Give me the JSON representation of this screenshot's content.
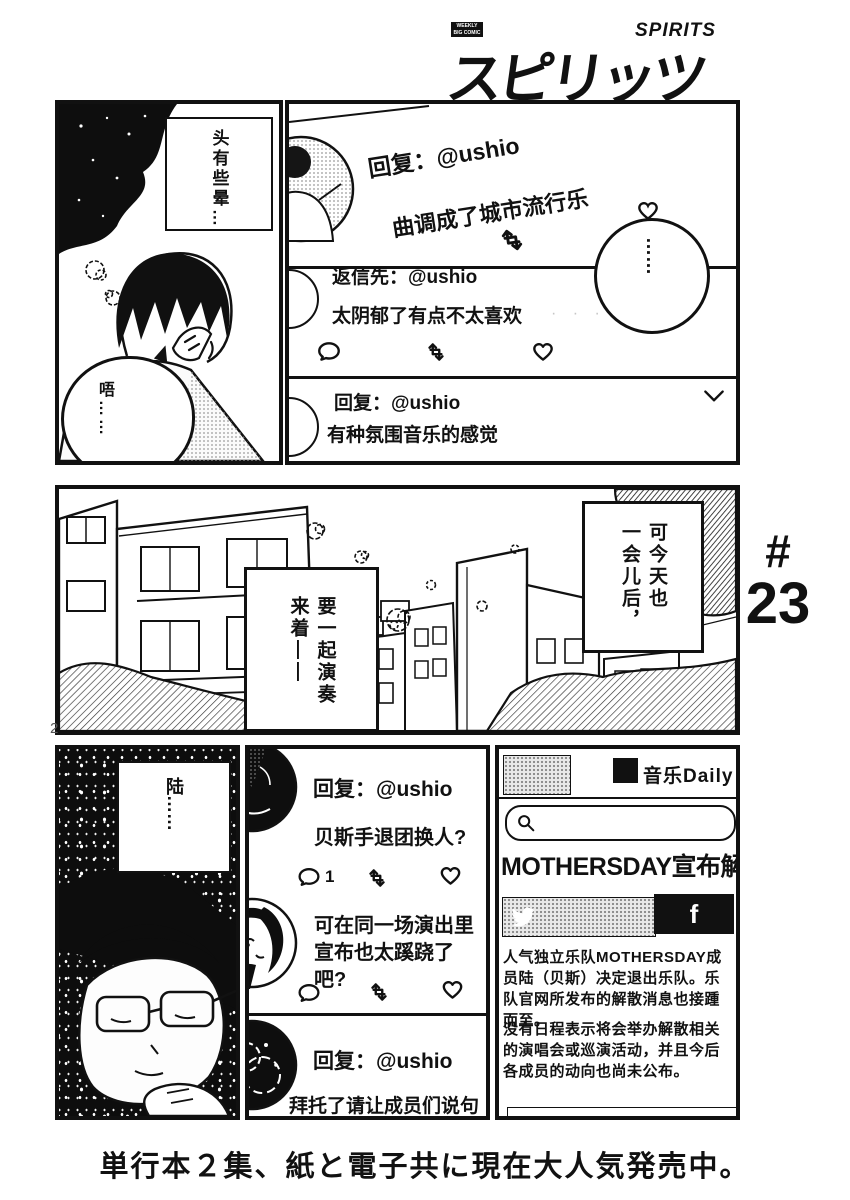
{
  "page": {
    "number": "2",
    "chapter_hash": "#",
    "chapter_number": "23",
    "bottom_caption": "単行本２集、紙と電子共に現在大人気発売中。"
  },
  "logo": {
    "weekly": "WEEKLY",
    "big_comic": "BIG COMIC",
    "title_kana": "スピリッツ",
    "spirits": "SPIRITS"
  },
  "panel_scene_top": {
    "caption": "头有些晕…",
    "speech_bubble": "唔……"
  },
  "panel_sns_top": {
    "tweet1": {
      "reply_label": "回复：@ushio",
      "text": "曲调成了城市流行乐"
    },
    "tweet2": {
      "reply_label": "返信先：@ushio",
      "text": "太阴郁了有点不太喜欢",
      "faint_marks": "· · ·"
    },
    "tweet3": {
      "reply_label": "回复：@ushio",
      "text": "有种氛围音乐的感觉"
    },
    "thought_balloon": "……"
  },
  "panel_street": {
    "caption_left": "要一起演奏\n来着——",
    "caption_right": "可今天也\n一会儿后，"
  },
  "panel_scene_bottom": {
    "caption": "陆……"
  },
  "panel_sns_bottom": {
    "tweet1": {
      "reply_label": "回复：@ushio",
      "text": "贝斯手退团换人?",
      "reply_count": "1"
    },
    "tweet2": {
      "text": "可在同一场演出里\n宣布也太蹊跷了吧?"
    },
    "tweet3": {
      "reply_label": "回复：@ushio",
      "text": "拜托了请让成员们说句话"
    }
  },
  "news_app": {
    "name": "音乐Daily",
    "headline": "MOTHERSDAY宣布解散",
    "facebook_label": "f",
    "body1": "人气独立乐队MOTHERSDAY成员陆（贝斯）决定退出乐队。乐队官网所发布的解散消息也接踵而至。",
    "body2": "没有日程表示将会举办解散相关的演唱会或巡演活动，并且今后各成员的动向也尚未公布。"
  },
  "colors": {
    "ink": "#111111",
    "paper": "#ffffff"
  }
}
